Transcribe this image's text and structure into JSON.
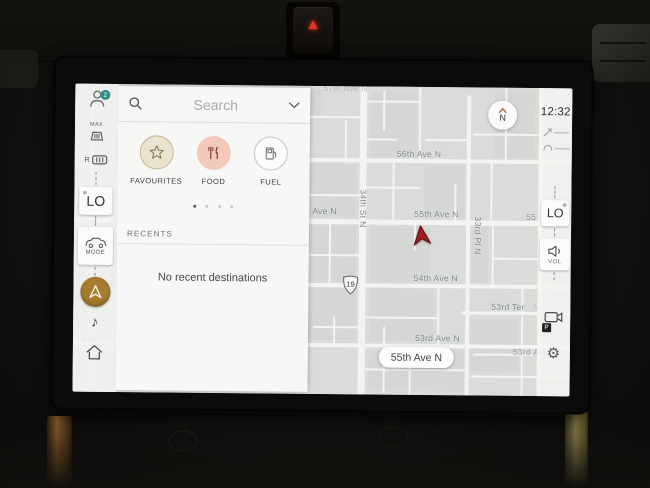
{
  "hazard": {
    "symbol": "▲"
  },
  "status": {
    "clock": "12:32"
  },
  "icons": {
    "snowflake": "❄",
    "music": "♪",
    "gear": "⚙"
  },
  "left_sidebar": {
    "profile_badge": "2",
    "max_defrost_label": "MAX",
    "rear_defrost_label": "R",
    "driver_temp": "LO",
    "mode_label": "MODE"
  },
  "right_sidebar": {
    "passenger_temp": "LO",
    "volume_label": "VOL",
    "parking_badge": "P"
  },
  "search_panel": {
    "placeholder": "Search",
    "categories": [
      {
        "label": "FAVOURITES"
      },
      {
        "label": "FOOD"
      },
      {
        "label": "FUEL"
      }
    ],
    "recents_header": "RECENTS",
    "recents_empty": "No recent destinations"
  },
  "map": {
    "compass_label": "N",
    "route_shield": "19",
    "current_street_pill": "55th Ave N",
    "labels": [
      {
        "text": "57th Ave N",
        "x": 248,
        "y": -3,
        "rot": 0,
        "o": 0.45
      },
      {
        "text": "56th Ave N",
        "x": 322,
        "y": 62,
        "rot": 0,
        "o": 1
      },
      {
        "text": "55th Ave N",
        "x": 340,
        "y": 122,
        "rot": 0,
        "o": 1
      },
      {
        "text": "55",
        "x": 452,
        "y": 124,
        "rot": 0,
        "o": 0.9
      },
      {
        "text": "54th Ave N",
        "x": 340,
        "y": 186,
        "rot": 0,
        "o": 1
      },
      {
        "text": "53rd Ter",
        "x": 418,
        "y": 214,
        "rot": 0,
        "o": 1
      },
      {
        "text": "N",
        "x": 460,
        "y": 214,
        "rot": 0,
        "o": 0.4
      },
      {
        "text": "53rd Ave N",
        "x": 342,
        "y": 246,
        "rot": 0,
        "o": 1
      },
      {
        "text": "53rd Ave N",
        "x": 440,
        "y": 259,
        "rot": 0,
        "o": 0.8
      },
      {
        "text": "Ave N",
        "x": 238,
        "y": 120,
        "rot": 0,
        "o": 1
      },
      {
        "text": "ve N",
        "x": 2,
        "y": 118,
        "rot": 0,
        "o": 0.7
      },
      {
        "text": "e N",
        "x": 8,
        "y": 251,
        "rot": 0,
        "o": 0.7
      },
      {
        "text": "34th St N",
        "x": 294,
        "y": 103,
        "rot": 90,
        "o": 1
      },
      {
        "text": "33rd Pl N",
        "x": 409,
        "y": 129,
        "rot": 90,
        "o": 1
      }
    ]
  }
}
